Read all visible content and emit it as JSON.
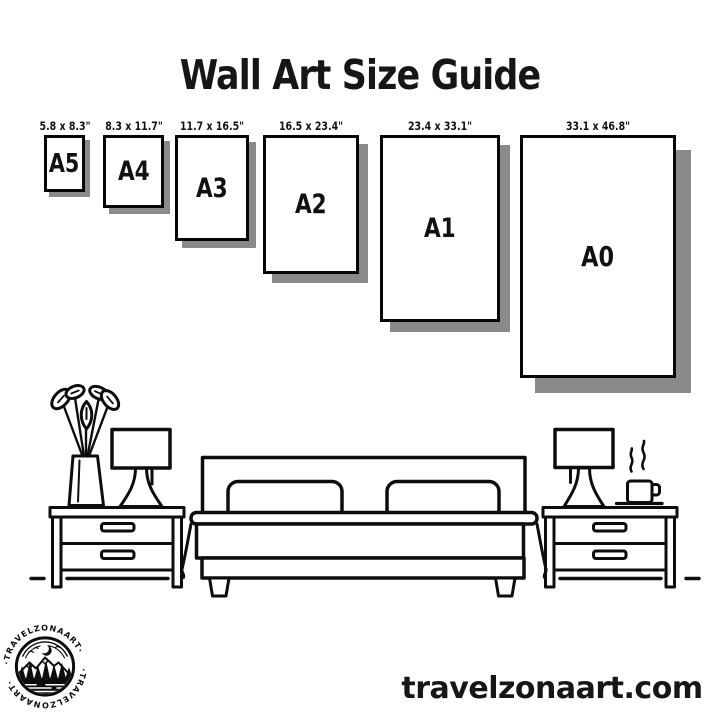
{
  "title": "Wall Art Size Guide",
  "website": "travelzonaart.com",
  "brand": {
    "name": "TRAVELZONAART",
    "badge_arc_text": "·TRAVELZONAART·"
  },
  "colors": {
    "ink": "#111111",
    "paper": "#ffffff",
    "shadow": "#8a8a8a",
    "background": "#ffffff"
  },
  "sizes": [
    {
      "name": "A5",
      "dimensions": "5.8 x 8.3\""
    },
    {
      "name": "A4",
      "dimensions": "8.3 x 11.7\""
    },
    {
      "name": "A3",
      "dimensions": "11.7 x 16.5\""
    },
    {
      "name": "A2",
      "dimensions": "16.5 x 23.4\""
    },
    {
      "name": "A1",
      "dimensions": "23.4 x 33.1\""
    },
    {
      "name": "A0",
      "dimensions": "33.1 x 46.8\""
    }
  ],
  "scene": {
    "description": "line-art bedroom: double bed with two pillows, two nightstands with two drawers each, two table lamps, flower vase, steaming coffee cup, dashed floor line"
  }
}
